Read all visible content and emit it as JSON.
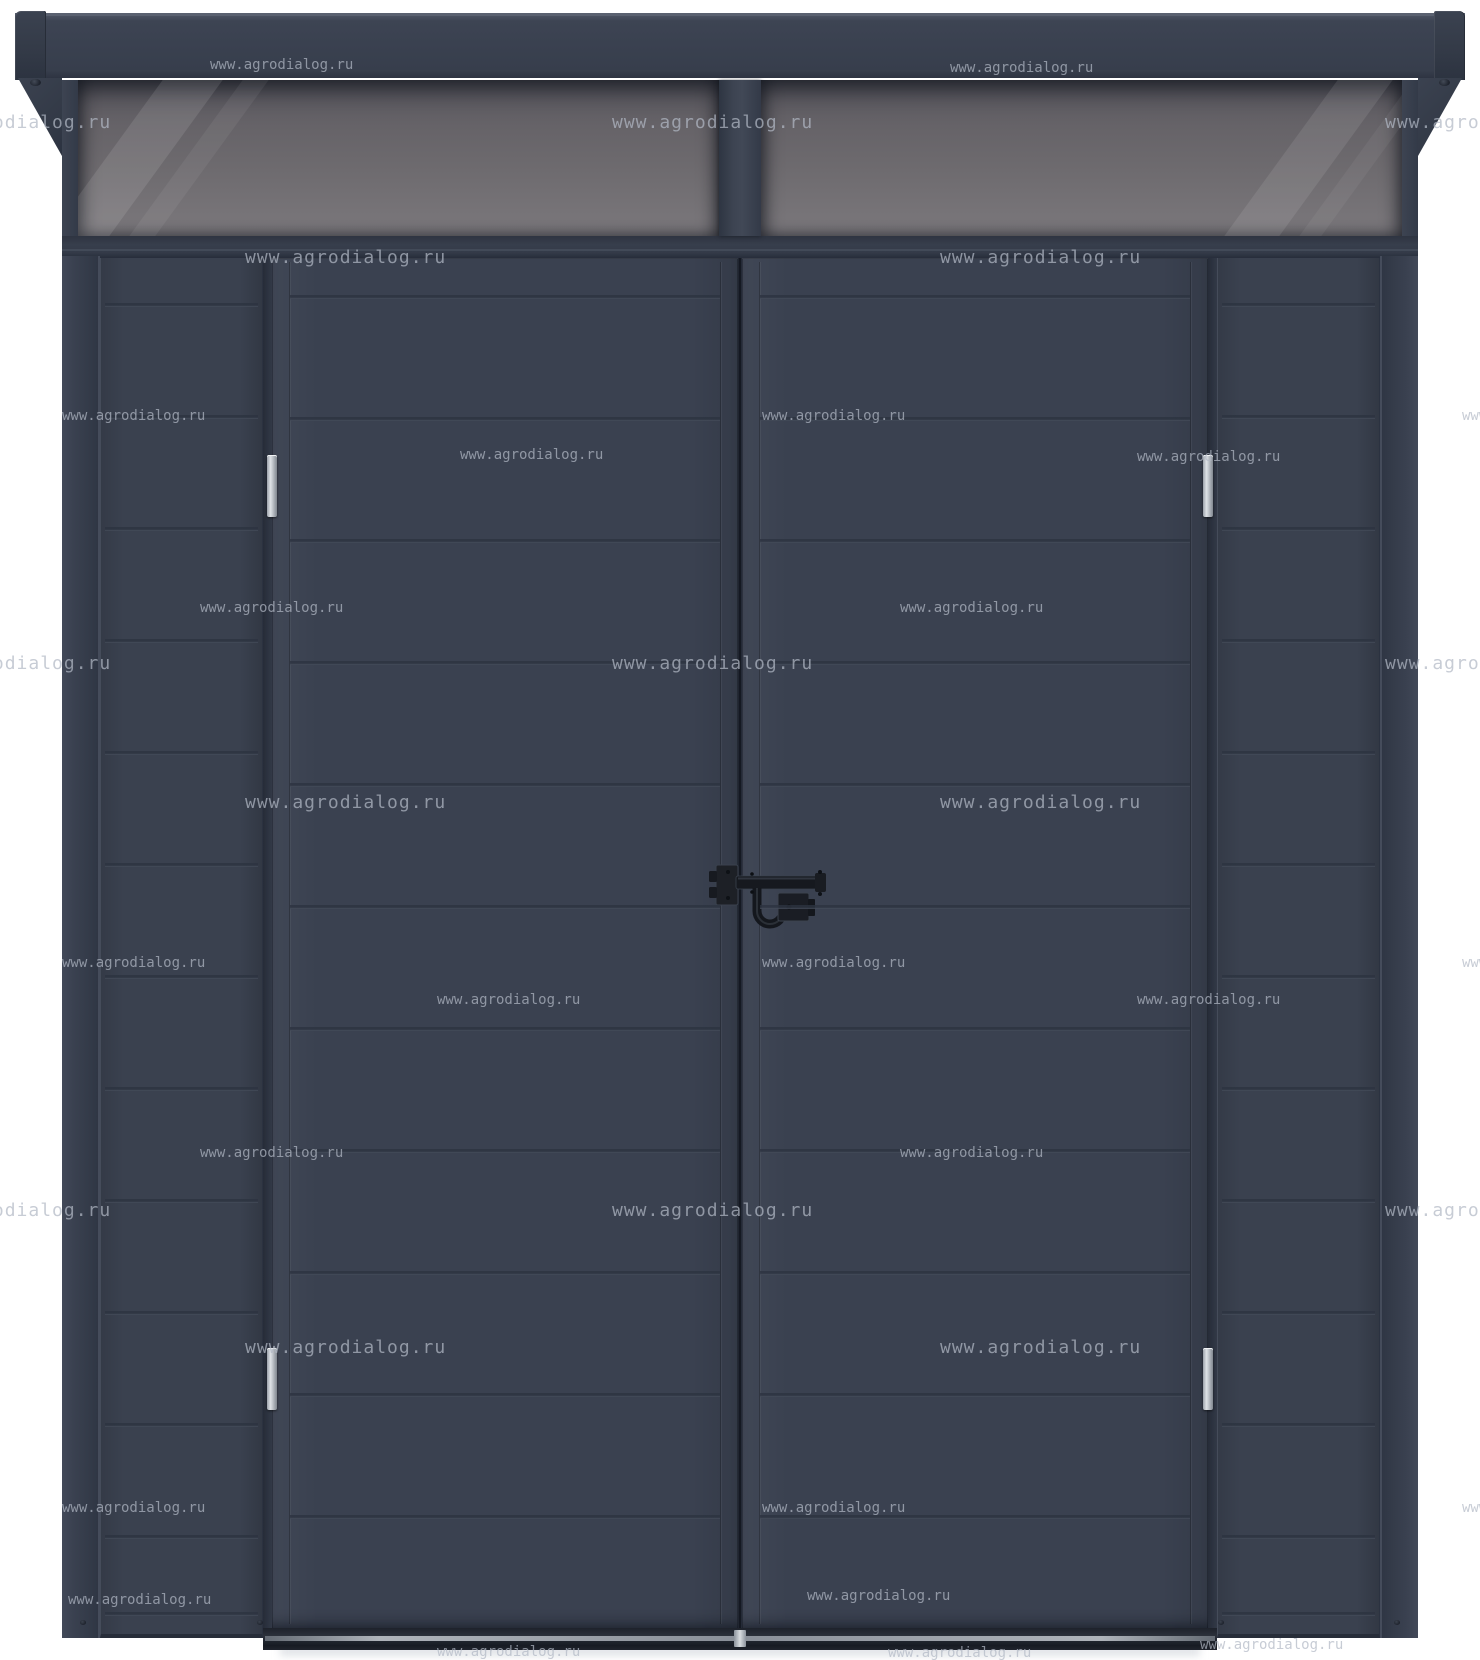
{
  "image": {
    "kind": "product-render",
    "subject": "Anthracite metal garden shed, front elevation: transom skylight under roof, double doors, side wall panels",
    "background_color": "#ffffff"
  },
  "watermark": {
    "text": "www.agrodialog.ru",
    "color": "#b2b9c5"
  },
  "palette": {
    "shed_body": "#3a4150",
    "trim_dark": "#2c3340",
    "roof_fascia_top_edge": "#5a6170",
    "end_cap": "#333a47",
    "glass_top": "#57555c",
    "glass_bottom": "#7b787c",
    "mullion": "#3d4452",
    "hinge_silver": "#dfe3e7",
    "lock_black": "#16191f",
    "threshold_silver": "#c7ccd2",
    "watermark_gray": "#b2b9c5"
  },
  "structure": {
    "skylight_panes": 2,
    "doors": 2,
    "hinges": 4,
    "side_panels": 2,
    "lock": "black double-door drop-bar latch at center",
    "door_seam_rows": 11,
    "side_panel_seam_rows": 13
  }
}
